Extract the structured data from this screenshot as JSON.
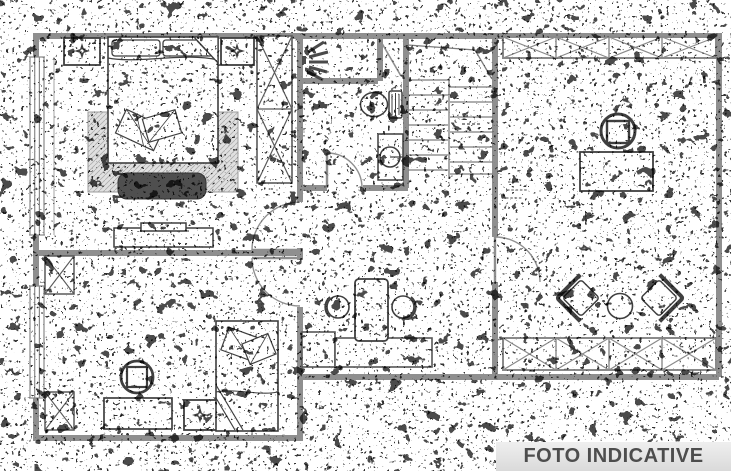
{
  "image": {
    "type": "scanned-floor-plan",
    "style": "noisy black-and-white architectural line drawing with heavy speckle",
    "background": "#ffffff",
    "wall_color": "#8f8f8f",
    "line_color": "#3f3f3f"
  },
  "banner": {
    "text": "FOTO INDICATIVE",
    "background": "#e4e4e4",
    "color": "#4d4d4d"
  },
  "plan": {
    "rooms": [
      {
        "name": "bedroom-main",
        "furniture": [
          "double-bed",
          "pillows",
          "nightstand-left",
          "nightstand-right",
          "ceiling-lamp-symbol",
          "rug",
          "bench",
          "wardrobe",
          "dresser-tv-stand"
        ]
      },
      {
        "name": "bathroom",
        "furniture": [
          "shower",
          "toilet",
          "washbasin-vanity"
        ]
      },
      {
        "name": "staircase",
        "furniture": [
          "stair-treads",
          "landing"
        ]
      },
      {
        "name": "living-room",
        "furniture": [
          "office-chair",
          "desk",
          "armchair-left",
          "armchair-right",
          "round-coffee-table",
          "closet-row-top",
          "closet-row-bottom"
        ]
      },
      {
        "name": "bedroom-second",
        "furniture": [
          "single-bed",
          "armchair",
          "desk",
          "nightstand",
          "wardrobe-module-top",
          "wardrobe-module-bottom"
        ]
      },
      {
        "name": "hallway-kitchenette",
        "furniture": [
          "counter-small",
          "counter-long",
          "high-table",
          "stool-left",
          "stool-right"
        ]
      }
    ],
    "door_count": 5,
    "window_count": 2
  }
}
